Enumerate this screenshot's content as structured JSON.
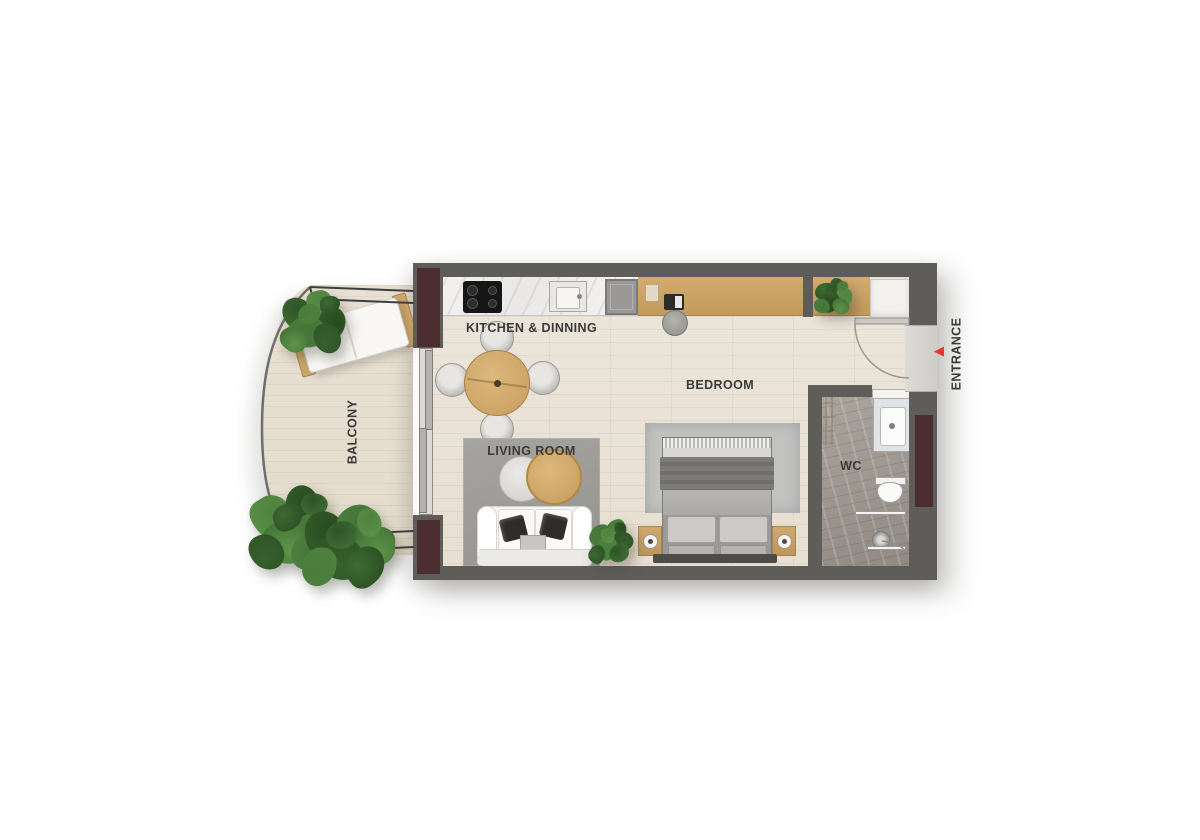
{
  "rooms": {
    "kitchen_dining": {
      "label": "KITCHEN & DINNING"
    },
    "living_room": {
      "label": "LIVING ROOM"
    },
    "bedroom": {
      "label": "BEDROOM"
    },
    "balcony": {
      "label": "BALCONY"
    },
    "wc": {
      "label": "WC"
    },
    "entrance": {
      "label": "ENTRANCE"
    }
  },
  "icons": {
    "entrance_arrow": "◀"
  },
  "colors": {
    "wall": "#5f5d5a",
    "structural_column": "#4c2e30",
    "interior_floor": "#eae3d7",
    "balcony_floor": "#e7e0d2",
    "wc_floor": "#a49d96",
    "living_rug": "#9c9b97",
    "bedroom_rug": "#c2c3c1",
    "wood_furniture": "#cda76c",
    "entrance_arrow": "#e5352b",
    "label_text": "#3a3a38"
  }
}
